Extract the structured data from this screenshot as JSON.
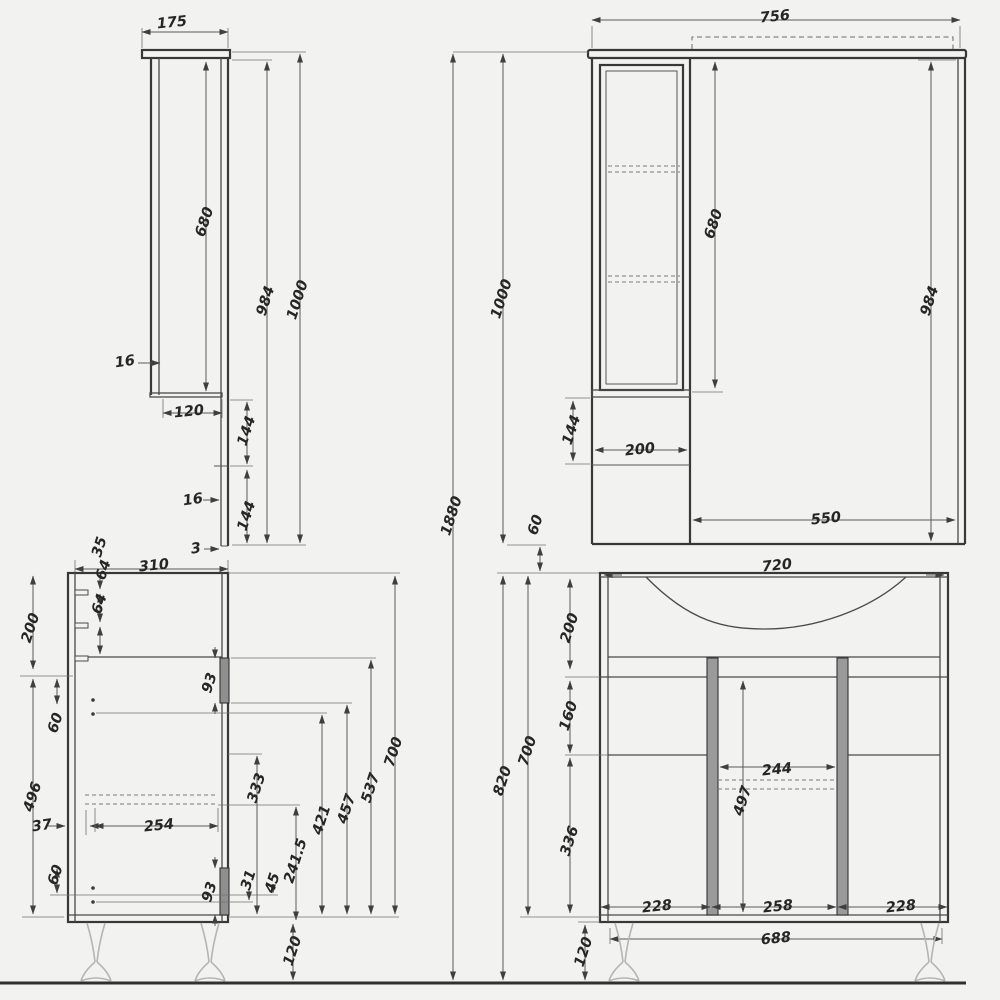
{
  "document": {
    "type": "technical-drawing",
    "subject": "Bathroom furniture set dimension drawing: mirror cabinet (side and front views) above a vanity sink cabinet (side and front views)",
    "units": "mm",
    "overall_height_label": "1880"
  },
  "style": {
    "background": "#f2f2f0",
    "part_line": "#383838",
    "dim_line": "#5a5a5a",
    "text": "#262626",
    "divider_fill": "#9a9a9a",
    "leg_line": "#b5b5b5"
  },
  "views": [
    {
      "id": "mirror-side",
      "title": "mirror cabinet side view",
      "dimensions": [
        {
          "text": "175",
          "x": 172,
          "y": 23,
          "rot": -6
        },
        {
          "text": "680",
          "x": 205,
          "y": 222,
          "rot": -72
        },
        {
          "text": "984",
          "x": 266,
          "y": 301,
          "rot": -72
        },
        {
          "text": "1000",
          "x": 298,
          "y": 300,
          "rot": -72
        },
        {
          "text": "16",
          "x": 125,
          "y": 362,
          "rot": -8
        },
        {
          "text": "120",
          "x": 189,
          "y": 412,
          "rot": -6
        },
        {
          "text": "144",
          "x": 247,
          "y": 431,
          "rot": -72
        },
        {
          "text": "16",
          "x": 193,
          "y": 500,
          "rot": -8
        },
        {
          "text": "144",
          "x": 247,
          "y": 516,
          "rot": -72
        },
        {
          "text": "3",
          "x": 196,
          "y": 549,
          "rot": -8
        }
      ]
    },
    {
      "id": "mirror-front",
      "title": "mirror cabinet front view",
      "dimensions": [
        {
          "text": "756",
          "x": 775,
          "y": 17,
          "rot": -6
        },
        {
          "text": "680",
          "x": 714,
          "y": 224,
          "rot": -72
        },
        {
          "text": "984",
          "x": 930,
          "y": 301,
          "rot": -72
        },
        {
          "text": "144",
          "x": 572,
          "y": 430,
          "rot": -72
        },
        {
          "text": "200",
          "x": 640,
          "y": 450,
          "rot": -6
        },
        {
          "text": "550",
          "x": 826,
          "y": 519,
          "rot": -6
        }
      ]
    },
    {
      "id": "overall",
      "title": "overall stack dimensions",
      "dimensions": [
        {
          "text": "1880",
          "x": 452,
          "y": 516,
          "rot": -72
        },
        {
          "text": "1000",
          "x": 502,
          "y": 299,
          "rot": -72
        },
        {
          "text": "60",
          "x": 536,
          "y": 525,
          "rot": -72
        }
      ]
    },
    {
      "id": "vanity-side",
      "title": "vanity cabinet side view",
      "dimensions": [
        {
          "text": "310",
          "x": 154,
          "y": 566,
          "rot": -6
        },
        {
          "text": "35",
          "x": 100,
          "y": 547,
          "rot": -72
        },
        {
          "text": "64",
          "x": 104,
          "y": 570,
          "rot": -72
        },
        {
          "text": "64",
          "x": 100,
          "y": 604,
          "rot": -72
        },
        {
          "text": "200",
          "x": 31,
          "y": 628,
          "rot": -72
        },
        {
          "text": "60",
          "x": 56,
          "y": 723,
          "rot": -72
        },
        {
          "text": "496",
          "x": 33,
          "y": 797,
          "rot": -72
        },
        {
          "text": "37",
          "x": 42,
          "y": 826,
          "rot": -8
        },
        {
          "text": "254",
          "x": 159,
          "y": 826,
          "rot": -6
        },
        {
          "text": "60",
          "x": 56,
          "y": 875,
          "rot": -72
        },
        {
          "text": "93",
          "x": 210,
          "y": 683,
          "rot": -72
        },
        {
          "text": "93",
          "x": 210,
          "y": 892,
          "rot": -72
        },
        {
          "text": "31",
          "x": 249,
          "y": 880,
          "rot": -72
        },
        {
          "text": "45",
          "x": 273,
          "y": 883,
          "rot": -72
        },
        {
          "text": "241.5",
          "x": 296,
          "y": 861,
          "rot": -72
        },
        {
          "text": "333",
          "x": 257,
          "y": 788,
          "rot": -72
        },
        {
          "text": "421",
          "x": 322,
          "y": 820,
          "rot": -72
        },
        {
          "text": "457",
          "x": 347,
          "y": 809,
          "rot": -72
        },
        {
          "text": "537",
          "x": 371,
          "y": 788,
          "rot": -72
        },
        {
          "text": "700",
          "x": 394,
          "y": 752,
          "rot": -72
        },
        {
          "text": "120",
          "x": 293,
          "y": 951,
          "rot": -72
        }
      ]
    },
    {
      "id": "vanity-front",
      "title": "vanity cabinet front view",
      "dimensions": [
        {
          "text": "720",
          "x": 777,
          "y": 566,
          "rot": -6
        },
        {
          "text": "200",
          "x": 570,
          "y": 628,
          "rot": -72
        },
        {
          "text": "160",
          "x": 569,
          "y": 716,
          "rot": -72
        },
        {
          "text": "336",
          "x": 570,
          "y": 841,
          "rot": -72
        },
        {
          "text": "700",
          "x": 528,
          "y": 751,
          "rot": -72
        },
        {
          "text": "820",
          "x": 503,
          "y": 781,
          "rot": -72
        },
        {
          "text": "244",
          "x": 777,
          "y": 770,
          "rot": -6
        },
        {
          "text": "497",
          "x": 743,
          "y": 801,
          "rot": -72
        },
        {
          "text": "228",
          "x": 657,
          "y": 907,
          "rot": -6
        },
        {
          "text": "258",
          "x": 778,
          "y": 907,
          "rot": -6
        },
        {
          "text": "228",
          "x": 901,
          "y": 907,
          "rot": -6
        },
        {
          "text": "688",
          "x": 776,
          "y": 939,
          "rot": -6
        },
        {
          "text": "120",
          "x": 584,
          "y": 952,
          "rot": -72
        }
      ]
    }
  ]
}
